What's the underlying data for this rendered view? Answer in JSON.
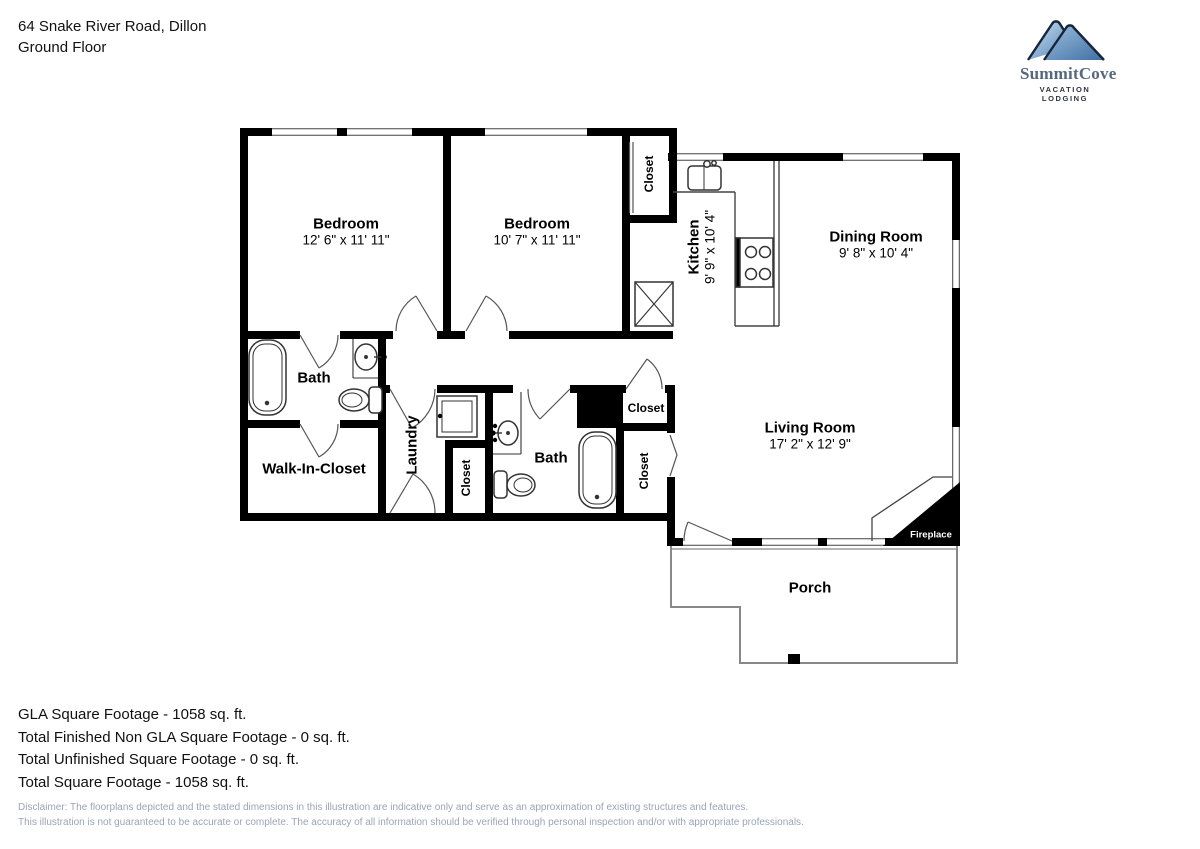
{
  "header": {
    "address": "64 Snake River Road, Dillon",
    "floor": "Ground Floor"
  },
  "logo": {
    "brand": "SummitCove",
    "tagline": "VACATION LODGING"
  },
  "rooms": {
    "bedroom1": {
      "label": "Bedroom",
      "dims": "12' 6\" x 11' 11\""
    },
    "bedroom2": {
      "label": "Bedroom",
      "dims": "10' 7\" x 11' 11\""
    },
    "kitchen": {
      "label": "Kitchen",
      "dims": "9' 9\" x 10' 4\""
    },
    "dining": {
      "label": "Dining Room",
      "dims": "9' 8\" x 10' 4\""
    },
    "living": {
      "label": "Living Room",
      "dims": "17' 2\" x 12' 9\""
    },
    "bath_main": {
      "label": "Bath"
    },
    "bath_hall": {
      "label": "Bath"
    },
    "walk_in_closet": {
      "label": "Walk-In-Closet"
    },
    "laundry": {
      "label": "Laundry"
    },
    "closet_bedroom2": {
      "label": "Closet"
    },
    "closet_laundry": {
      "label": "Closet"
    },
    "closet_hall_upper": {
      "label": "Closet"
    },
    "closet_hall_lower": {
      "label": "Closet"
    },
    "porch": {
      "label": "Porch"
    },
    "fireplace": {
      "label": "Fireplace"
    }
  },
  "summary": {
    "lines": [
      "GLA Square Footage - 1058 sq. ft.",
      "Total Finished Non GLA Square Footage - 0 sq. ft.",
      "Total Unfinished Square Footage - 0 sq. ft.",
      "Total Square Footage - 1058 sq. ft."
    ]
  },
  "disclaimer": {
    "line1": "Disclaimer: The floorplans depicted and the stated dimensions in this illustration are indicative only and serve as an approximation of existing structures and features.",
    "line2": "This illustration is not guaranteed to be accurate or complete. The accuracy of all information should be verified through personal inspection and/or with appropriate professionals."
  },
  "colors": {
    "wall": "#000000",
    "thin_line": "#555555",
    "porch_line": "#888888",
    "disclaimer_text": "#9aa4b8",
    "logo_mountain_light": "#aecbe6",
    "logo_mountain_dark": "#3f6fa3",
    "logo_text": "#56687f"
  }
}
